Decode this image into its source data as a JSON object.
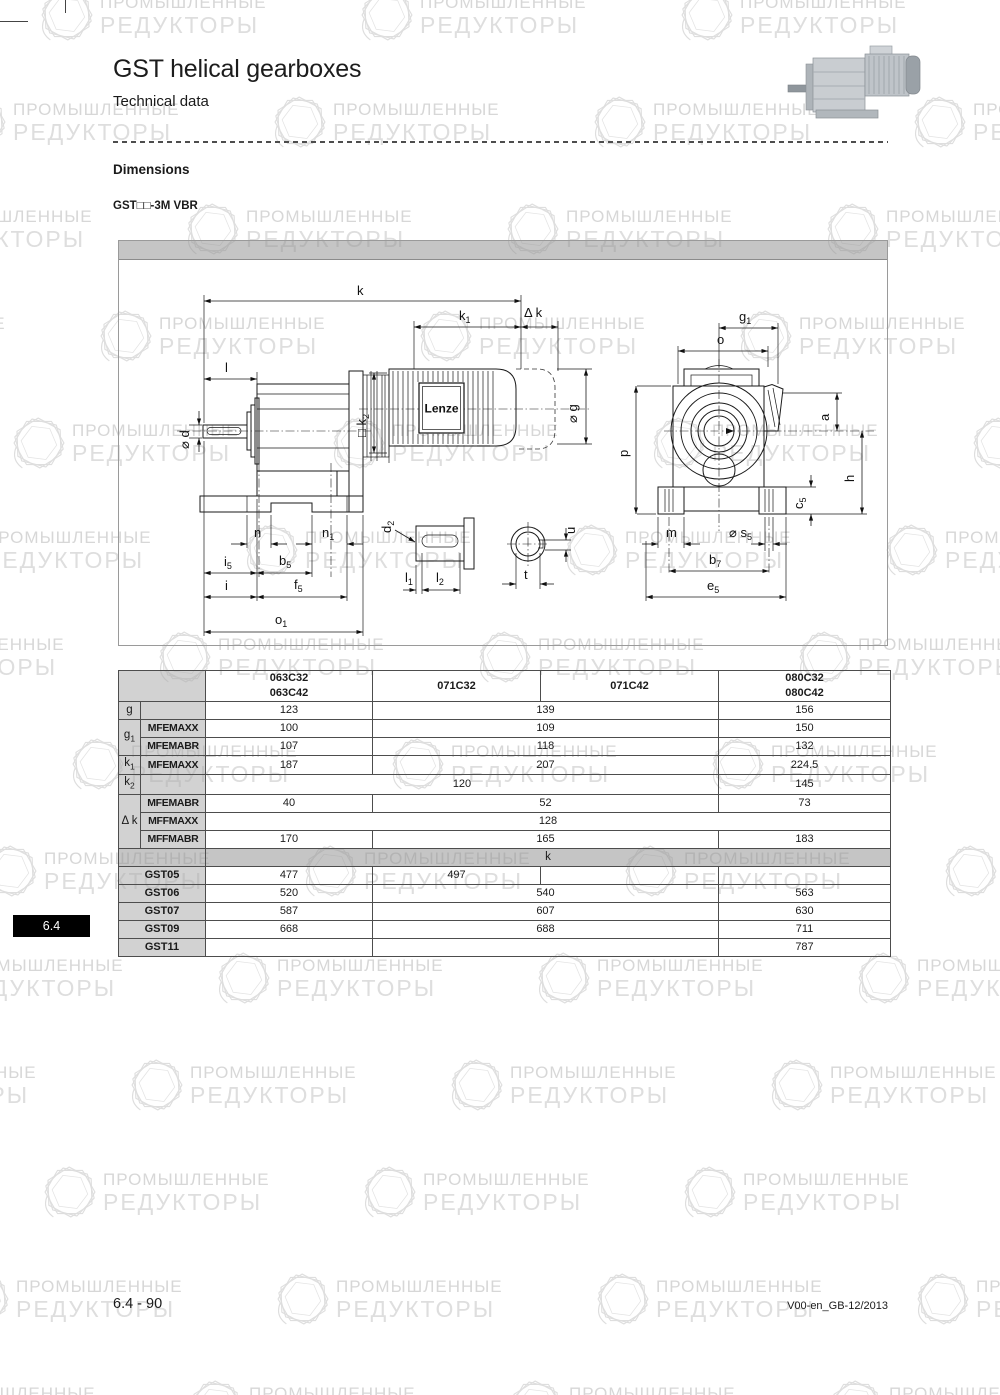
{
  "header": {
    "title": "GST helical gearboxes",
    "subtitle": "Technical data"
  },
  "section": {
    "heading": "Dimensions",
    "model": "GST□□-3M VBR"
  },
  "side_tab": "6.4",
  "footer": {
    "page": "6.4 - 90",
    "doc": "V00-en_GB-12/2013"
  },
  "watermark": {
    "line1": "ПРОМЫШЛЕННЫЕ",
    "line2": "РЕДУКТОРЫ"
  },
  "colors": {
    "line": "#1a1a1a",
    "band_gray": "#c2c2c2",
    "table_gray": "#dcdcdc",
    "tab_bg": "#000000",
    "tab_fg": "#ffffff",
    "watermark": "#dcdcdc"
  },
  "drawing": {
    "logo": "Lenze",
    "labels": {
      "k": {
        "b": "k",
        "s": ""
      },
      "k1": {
        "b": "k",
        "s": "1"
      },
      "dk": {
        "b": "Δ k",
        "s": ""
      },
      "l": {
        "b": "l",
        "s": ""
      },
      "d": {
        "b": "⌀ d",
        "s": ""
      },
      "k2": {
        "b": "□ k",
        "s": "2"
      },
      "g": {
        "b": "⌀ g",
        "s": ""
      },
      "n": {
        "b": "n",
        "s": ""
      },
      "n1": {
        "b": "n",
        "s": "1"
      },
      "i5": {
        "b": "i",
        "s": "5"
      },
      "b5": {
        "b": "b",
        "s": "5"
      },
      "i": {
        "b": "i",
        "s": ""
      },
      "f5": {
        "b": "f",
        "s": "5"
      },
      "o1": {
        "b": "o",
        "s": "1"
      },
      "d2": {
        "b": "d",
        "s": "2"
      },
      "l1": {
        "b": "l",
        "s": "1"
      },
      "l2": {
        "b": "l",
        "s": "2"
      },
      "u": {
        "b": "u",
        "s": ""
      },
      "t": {
        "b": "t",
        "s": ""
      },
      "g1": {
        "b": "g",
        "s": "1"
      },
      "o": {
        "b": "o",
        "s": ""
      },
      "p": {
        "b": "p",
        "s": ""
      },
      "a": {
        "b": "a",
        "s": ""
      },
      "h": {
        "b": "h",
        "s": ""
      },
      "c5": {
        "b": "c",
        "s": "5"
      },
      "m": {
        "b": "m",
        "s": ""
      },
      "s5": {
        "b": "⌀ s",
        "s": "5"
      },
      "b7": {
        "b": "b",
        "s": "7"
      },
      "e5": {
        "b": "e",
        "s": "5"
      }
    }
  },
  "table": {
    "head": {
      "c1t": "063C32",
      "c1b": "063C42",
      "c2t": "071C32",
      "c3t": "071C42",
      "c4t": "080C32",
      "c4b": "080C42"
    },
    "g": {
      "l": "g",
      "v1": "123",
      "v23": "139",
      "v4": "156"
    },
    "g1": {
      "l": "g",
      "ls": "1",
      "r1": {
        "sl": "MFEMAXX",
        "v1": "100",
        "v23": "109",
        "v4": "150"
      },
      "r2": {
        "sl": "MFEMABR",
        "v1": "107",
        "v23": "118",
        "v4": "132"
      }
    },
    "k1": {
      "l": "k",
      "ls": "1",
      "sl": "MFEMAXX",
      "v1": "187",
      "v23": "207",
      "v4": "224.5"
    },
    "k2": {
      "l": "k",
      "ls": "2",
      "v123": "120",
      "v4": "145"
    },
    "dk": {
      "l": "Δ k",
      "r1": {
        "sl": "MFEMABR",
        "v1": "40",
        "v23": "52",
        "v4": "73"
      },
      "r2": {
        "sl": "MFFMAXX",
        "v1234": "128"
      },
      "r3": {
        "sl": "MFFMABR",
        "v1": "170",
        "v23": "165",
        "v4": "183"
      }
    },
    "kband": "k",
    "gst05": {
      "l": "GST05",
      "v1": "477",
      "v2": "497",
      "v3": "",
      "v4": ""
    },
    "gst06": {
      "l": "GST06",
      "v1": "520",
      "v23": "540",
      "v4": "563"
    },
    "gst07": {
      "l": "GST07",
      "v1": "587",
      "v23": "607",
      "v4": "630"
    },
    "gst09": {
      "l": "GST09",
      "v1": "668",
      "v23": "688",
      "v4": "711"
    },
    "gst11": {
      "l": "GST11",
      "v1": "",
      "v23": "",
      "v4": "787"
    }
  }
}
